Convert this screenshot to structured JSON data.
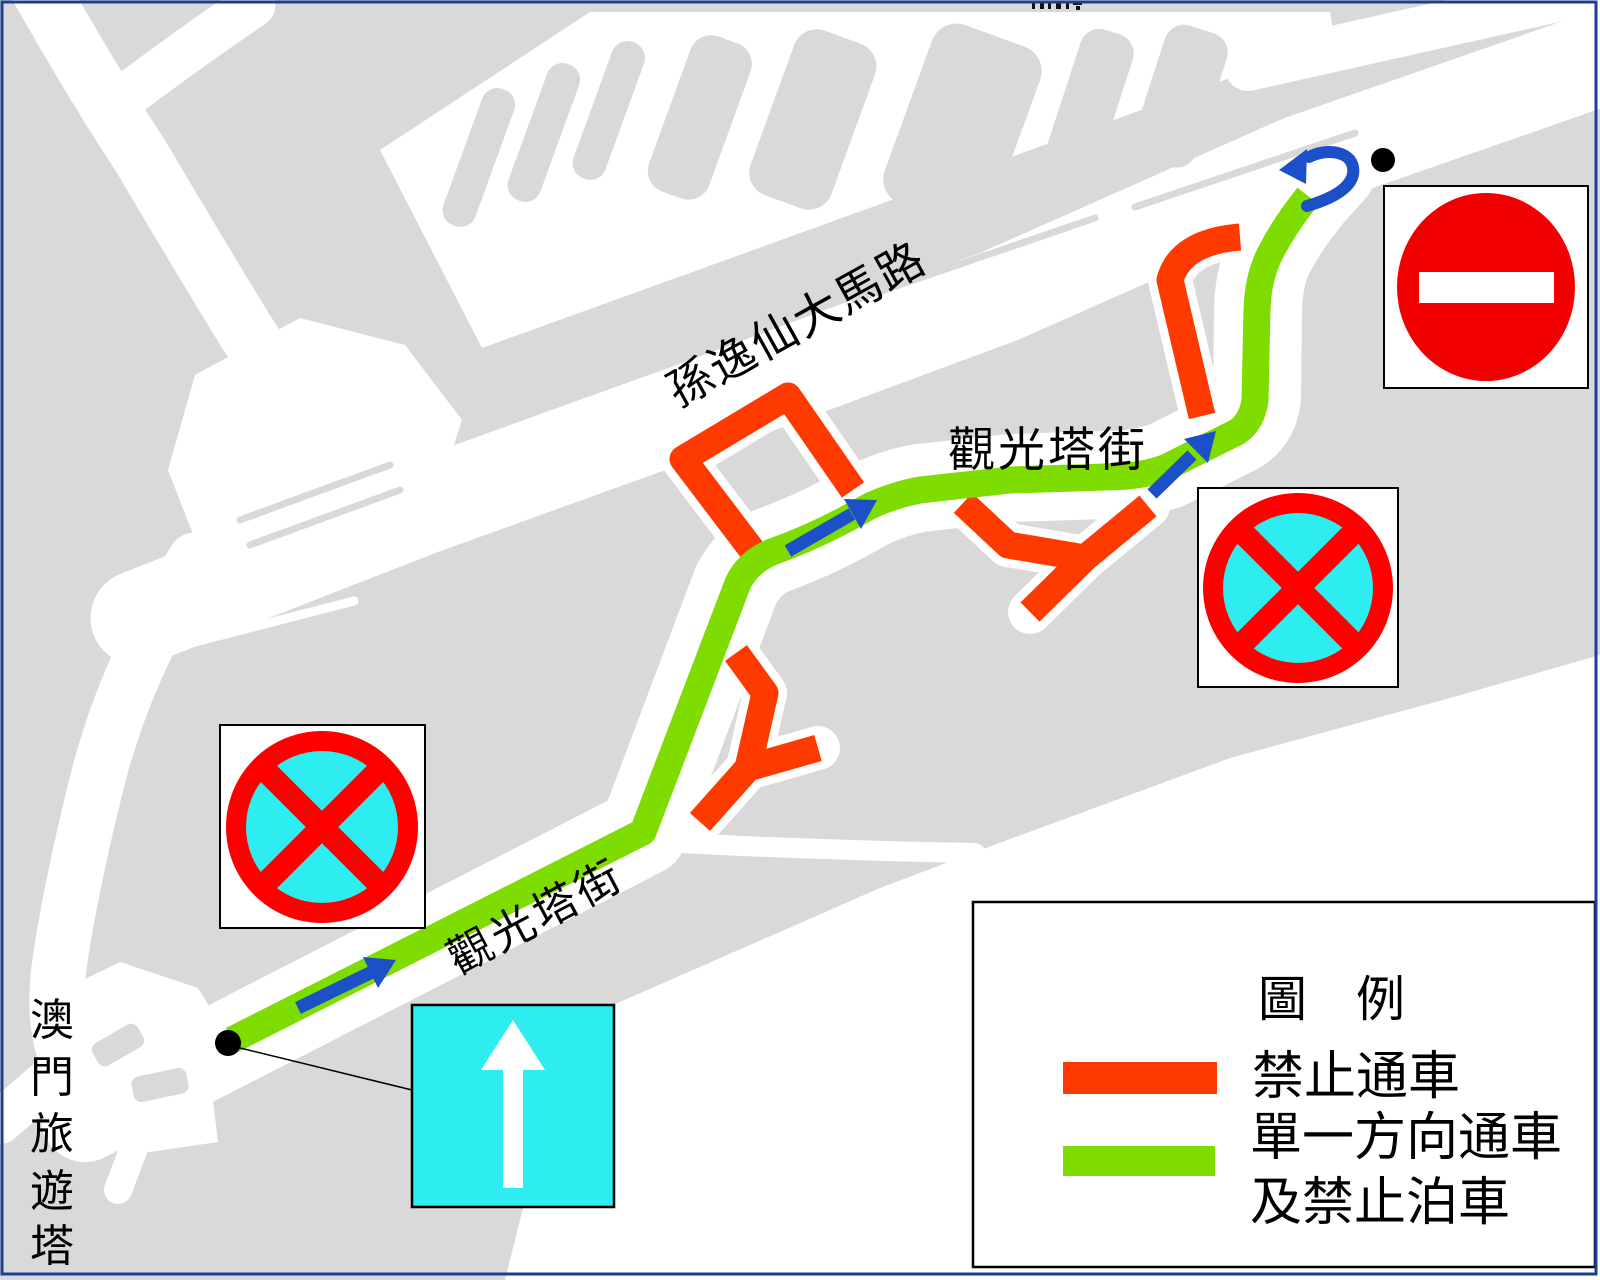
{
  "map": {
    "labels": {
      "avenue_road": "孫逸仙大馬路",
      "street_upper": "觀光塔街",
      "street_lower": "觀光塔街",
      "tower_chars": [
        "澳",
        "門",
        "旅",
        "遊",
        "塔"
      ],
      "tower_full": "澳門旅遊塔"
    },
    "legend": {
      "title": "圖　例",
      "items": [
        {
          "label": "禁止通車",
          "swatch_color": "#FF3A00"
        },
        {
          "label_line1": "單一方向通車",
          "label_line2": "及禁止泊車",
          "swatch_color": "#7EDC00"
        }
      ]
    },
    "signs": {
      "no_entry": "red-circle-white-bar",
      "no_stopping_left": "red-ring-cyan-disc-red-x",
      "no_stopping_right": "red-ring-cyan-disc-red-x",
      "one_way": "cyan-square-white-up-arrow"
    },
    "colors": {
      "land_gray": "#D9D9D9",
      "closed_road_orange": "#FF3A00",
      "one_way_route_green": "#7EDC00",
      "direction_arrow_blue": "#1B50C8",
      "sign_red": "#F00000",
      "sign_cyan": "#2EEDF0",
      "image_border_blue": "#1C3F94"
    }
  }
}
